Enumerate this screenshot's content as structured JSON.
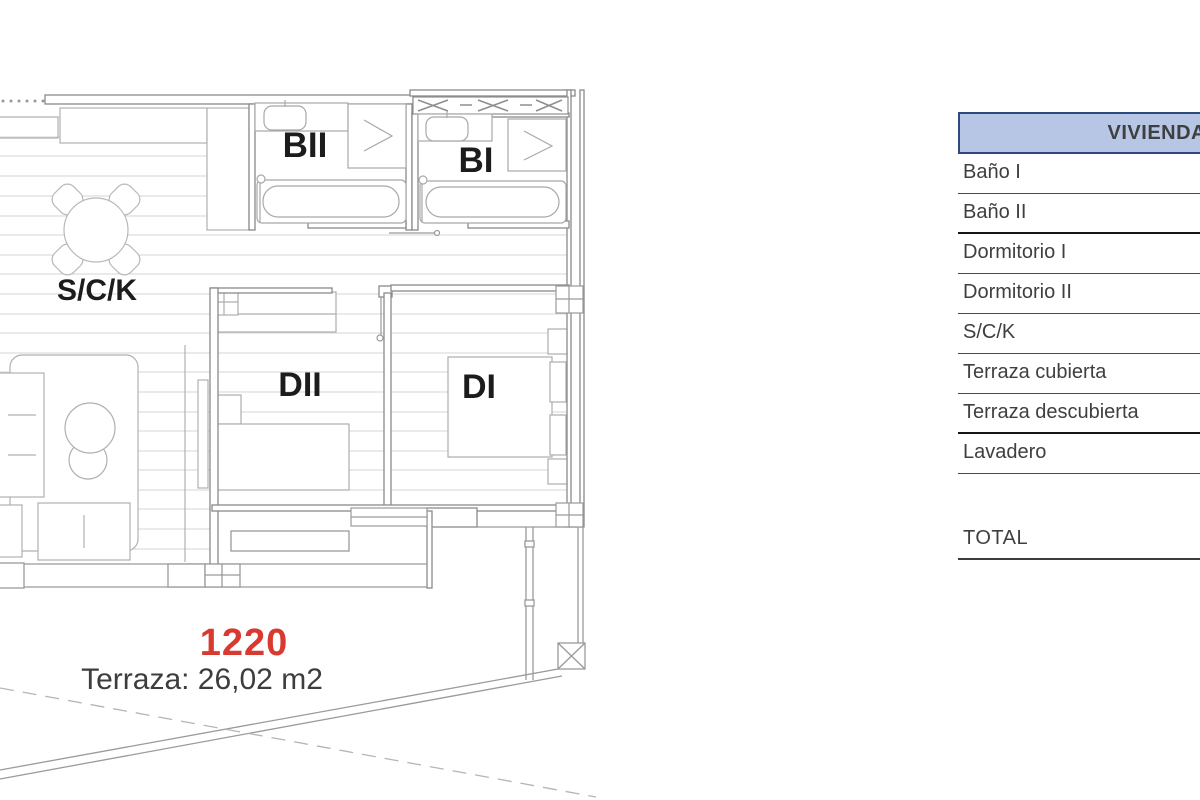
{
  "plan": {
    "unit_number": "1220",
    "terrace_label": "Terraza: 26,02 m2",
    "rooms": {
      "sck": "S/C/K",
      "banio2": "BII",
      "banio1": "BI",
      "dorm2": "DII",
      "dorm1": "DI"
    },
    "colors": {
      "unit_number": "#d93a30",
      "wall": "#8a8a8a",
      "floor_line": "#d4d4d4",
      "furniture": "#b0b0b0",
      "label_text": "#1c1c1c",
      "terrace_text": "#3d3d3d"
    }
  },
  "table": {
    "header": "VIVIENDA",
    "header_bg": "#b6c6e4",
    "header_border": "#2c4a7c",
    "rows": [
      {
        "label": "Baño I"
      },
      {
        "label": "Baño II"
      },
      {
        "label": "Dormitorio I"
      },
      {
        "label": "Dormitorio II"
      },
      {
        "label": "S/C/K"
      },
      {
        "label": "Terraza cubierta"
      },
      {
        "label": "Terraza descubierta"
      },
      {
        "label": "Lavadero"
      }
    ],
    "total_label": "TOTAL"
  }
}
